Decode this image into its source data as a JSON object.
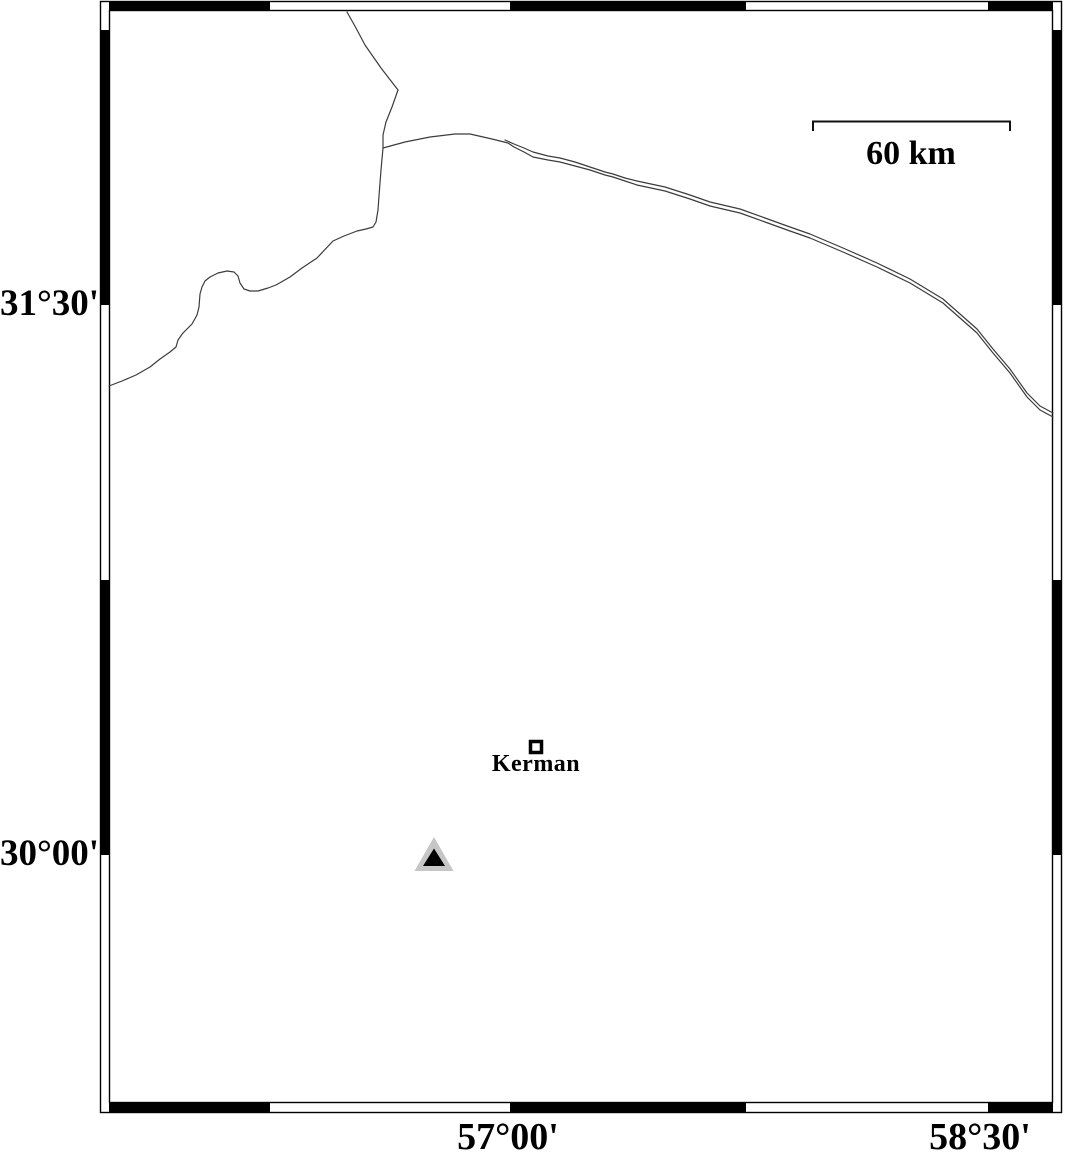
{
  "frame": {
    "lat_ticks": [
      {
        "label": "31°30'"
      },
      {
        "label": "30°00'"
      }
    ],
    "lon_ticks": [
      {
        "label": "57°00'"
      },
      {
        "label": "58°30'"
      }
    ]
  },
  "scale_bar": {
    "label": "60 km"
  },
  "features": {
    "city": {
      "label": "Kerman"
    }
  },
  "colors": {
    "background": "#ffffff",
    "frame": "#000000",
    "map_line": "#3c3c3c",
    "scale_bar": "#111111",
    "station_outer": "#c6c6c6",
    "station_inner": "#000000",
    "city_marker_fill": "#ffffff"
  }
}
